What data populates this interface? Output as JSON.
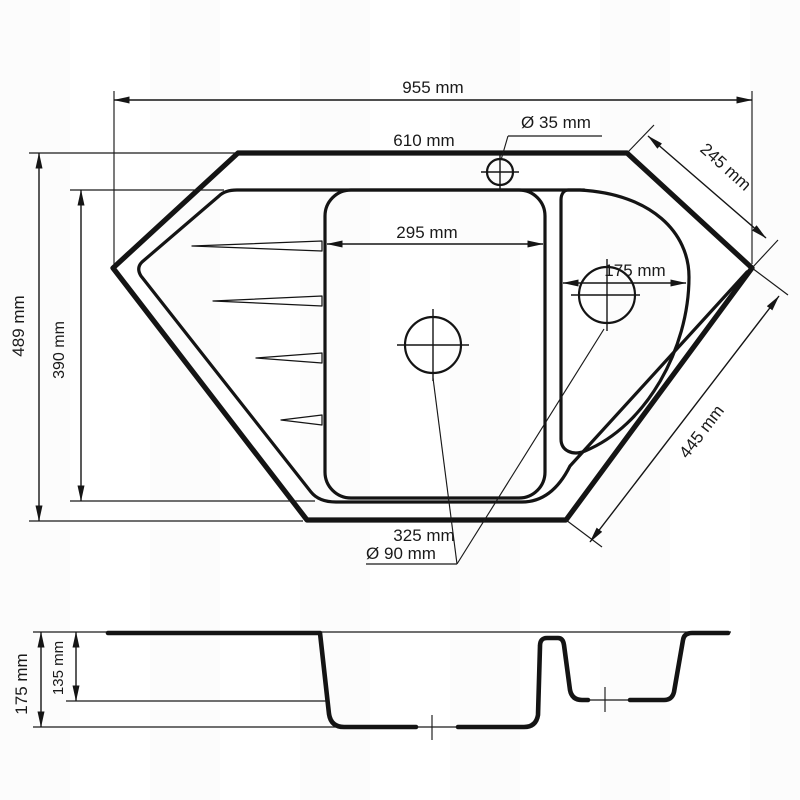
{
  "drawing": {
    "type": "corner kitchen sink technical drawing",
    "line_color": "#141414",
    "background_color": "#ffffff"
  },
  "top_view": {
    "labels": {
      "overall_width": "955 mm",
      "top_edge": "610 mm",
      "faucet_hole": "Ø 35 mm",
      "edge_top_right": "245 mm",
      "height_overall": "489 mm",
      "height_inner": "390 mm",
      "main_bowl_width": "295 mm",
      "small_bowl_width": "175 mm",
      "edge_bottom_right": "445 mm",
      "bottom_edge": "325 mm",
      "drain_diameter": "Ø 90 mm"
    }
  },
  "section_view": {
    "labels": {
      "depth_total": "175 mm",
      "depth_small_bowl": "135 mm"
    }
  }
}
